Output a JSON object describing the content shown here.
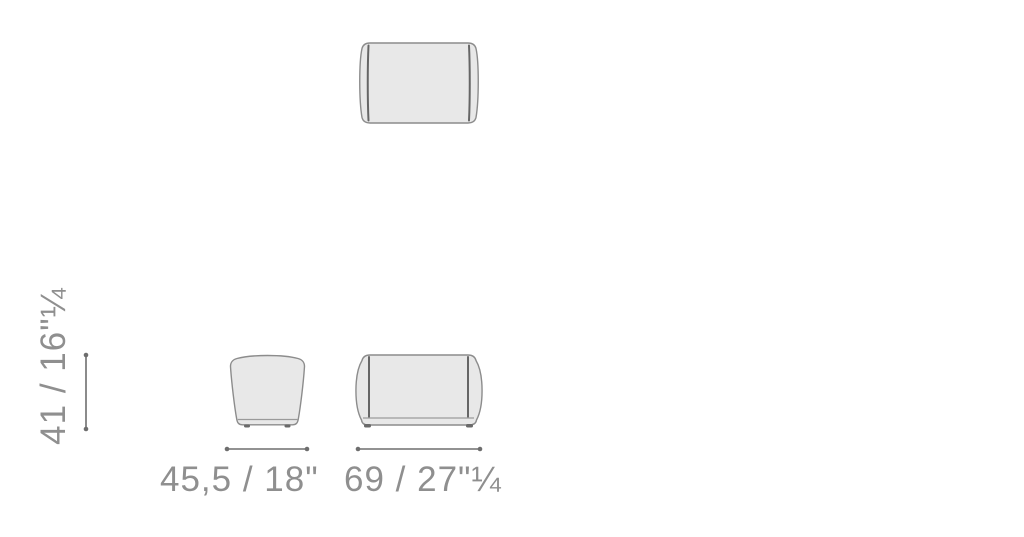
{
  "drawing": {
    "type": "furniture-dimension-diagram",
    "subject": "ottoman-pouf",
    "dimensions": {
      "height_label": "41 / 16\"¼",
      "depth_label": "45,5 / 18\"",
      "width_label": "69 / 27\"¼"
    },
    "colors": {
      "background": "#ffffff",
      "shape_fill": "#e8e8e8",
      "shape_outline": "#8c8c8c",
      "seam_line": "#666666",
      "base_line": "#9a9a9a",
      "feet": "#6a6a6a",
      "dimension_line": "#6e6e6e",
      "label_text": "#8f8f8f"
    }
  }
}
